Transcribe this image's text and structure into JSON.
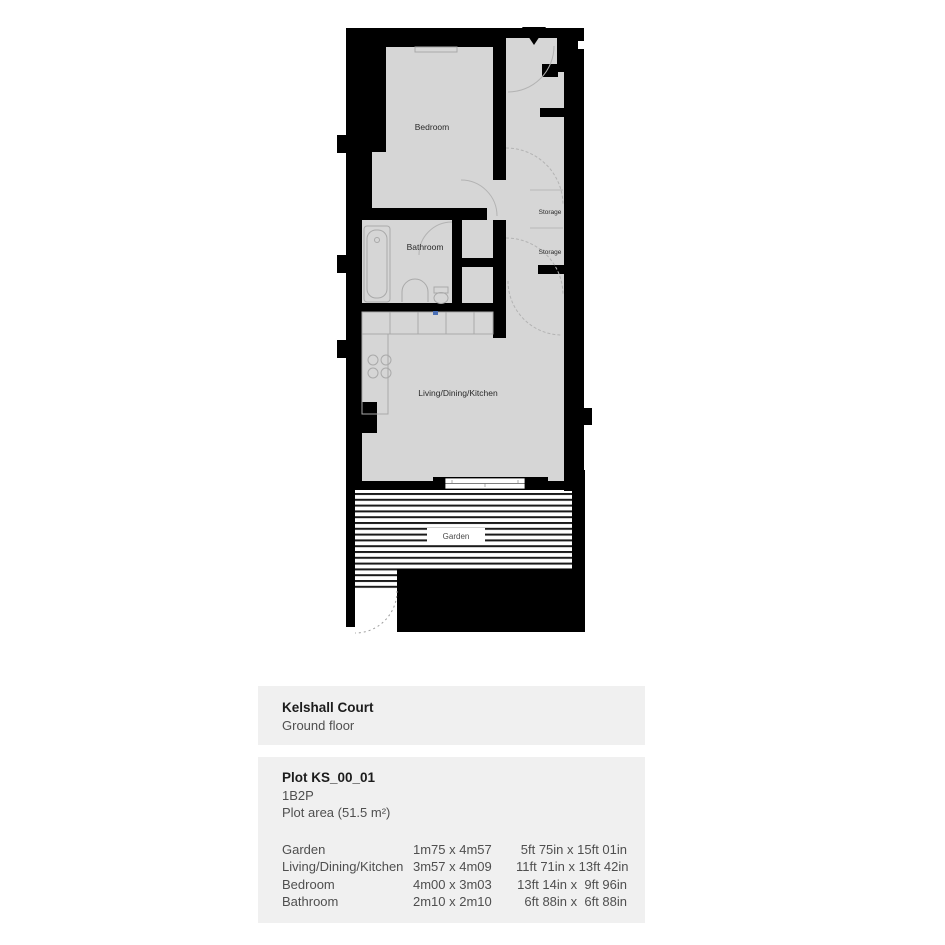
{
  "colors": {
    "wall": "#000000",
    "floor": "#d6d6d6",
    "panel_bg": "#f0f0f0",
    "fixture_line": "#a9a9a9",
    "stripe": "#1a1a1a",
    "text_dark": "#1c1c1c",
    "text_body": "#4f4f4f",
    "sink_accent": "#4a6fb5"
  },
  "floorplan": {
    "labels": {
      "bedroom": "Bedroom",
      "bathroom": "Bathroom",
      "living": "Living/Dining/Kitchen",
      "storage": "Storage",
      "garden": "Garden"
    }
  },
  "info": {
    "building": {
      "name": "Kelshall Court",
      "floor": "Ground floor"
    },
    "plot": {
      "id": "Plot KS_00_01",
      "type": "1B2P",
      "area": "Plot area (51.5 m²)"
    },
    "dimensions": [
      {
        "room": "Garden",
        "metric": "1m75 x 4m57",
        "imperial": " 5ft 75in x 15ft 01in"
      },
      {
        "room": "Living/Dining/Kitchen",
        "metric": "3m57 x 4m09",
        "imperial": "11ft 71in x 13ft 42in"
      },
      {
        "room": "Bedroom",
        "metric": "4m00 x 3m03",
        "imperial": "13ft 14in x  9ft 96in"
      },
      {
        "room": "Bathroom",
        "metric": "2m10 x 2m10",
        "imperial": " 6ft 88in x  6ft 88in"
      }
    ]
  }
}
